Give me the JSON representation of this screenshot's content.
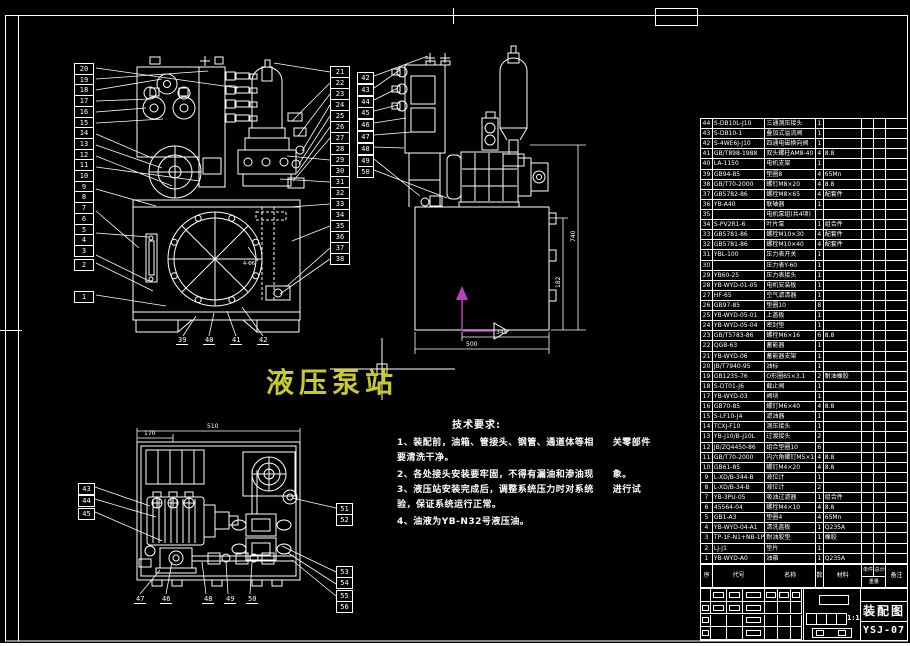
{
  "sheet": {
    "bg_color": "#000000",
    "line_color": "#ffffff",
    "title_color": "#c9c92a",
    "ucs_color": "#c03cc0"
  },
  "title": {
    "text": "液压泵站"
  },
  "tech": {
    "heading": "技术要求:",
    "lines": [
      "1、装配前，油箱、管接头、钢管、通道体等相　　关零部件",
      "要清洗干净。",
      "2、各处接头安装要牢固，不得有漏油和渗油现　　象。",
      "3、液压站安装完成后，调整系统压力时对系统　　进行试",
      "验，保证系统运行正常。",
      "4、油液为YB-N32号液压油。"
    ]
  },
  "dimensions": {
    "side_height": "740",
    "side_inner": "182",
    "side_width_inner": "345",
    "side_width": "500",
    "plan_width": "510",
    "plan_width_inner": "170",
    "front_hole_note": "4-Φ6"
  },
  "callouts": {
    "front_left": [
      "20",
      "19",
      "18",
      "17",
      "16",
      "15",
      "14",
      "13",
      "12",
      "11",
      "10",
      "9",
      "8",
      "7",
      "6",
      "5",
      "4",
      "3"
    ],
    "front_left_lower": [
      "2",
      "1"
    ],
    "front_right": [
      "21",
      "22",
      "23",
      "24",
      "25",
      "26",
      "27",
      "28",
      "29",
      "30",
      "31",
      "32",
      "33",
      "34",
      "35",
      "36",
      "37",
      "38"
    ],
    "front_bottom": [
      "39",
      "40",
      "41",
      "42"
    ],
    "side_left": [
      "42",
      "43",
      "44",
      "45",
      "46",
      "47",
      "48",
      "49",
      "50"
    ],
    "plan_left": [
      "43",
      "44",
      "45"
    ],
    "plan_bottom": [
      "47",
      "46",
      "48",
      "49",
      "50"
    ],
    "plan_right": [
      "51",
      "52",
      "53",
      "54",
      "55",
      "56"
    ]
  },
  "bom": {
    "headers": [
      "序号",
      "代号",
      "名称",
      "数量",
      "材料",
      "单件",
      "总计",
      "重量",
      "备注"
    ],
    "rows": [
      [
        "44",
        "S-DB10L-J10",
        "三通测压接头",
        "1",
        ""
      ],
      [
        "43",
        "S-DB10-1",
        "叠加式溢流阀",
        "1",
        ""
      ],
      [
        "42",
        "S-4WE6J-J10",
        "四通电磁换向阀",
        "1",
        ""
      ],
      [
        "41",
        "GB/T898-1988",
        "双头螺柱AM8-40",
        "4",
        "8.8"
      ],
      [
        "40",
        "LA-1150",
        "电机支架",
        "1",
        ""
      ],
      [
        "39",
        "GB94-85",
        "垫圈8",
        "4",
        "65Mn"
      ],
      [
        "38",
        "GB/T70-2000",
        "螺钉M8×20",
        "4",
        "8.8"
      ],
      [
        "37",
        "GB5782-86",
        "螺栓M8×65",
        "4",
        "配套件"
      ],
      [
        "36",
        "YB-A40",
        "联轴器",
        "1",
        ""
      ],
      [
        "35",
        "",
        "电机泵组(共4项)",
        "",
        ""
      ],
      [
        "34",
        "S-PV2R1-6",
        "叶片泵",
        "1",
        "组合件"
      ],
      [
        "33",
        "GB5781-86",
        "螺栓M10×30",
        "4",
        "配套件"
      ],
      [
        "32",
        "GB5781-86",
        "螺栓M10×40",
        "4",
        "配套件"
      ],
      [
        "31",
        "YBL-100",
        "压力表开关",
        "1",
        ""
      ],
      [
        "30",
        "",
        "压力表Y-60",
        "1",
        ""
      ],
      [
        "29",
        "YB60-25",
        "压力表接头",
        "1",
        ""
      ],
      [
        "28",
        "YB-WYD-01-05",
        "电机安装板",
        "1",
        ""
      ],
      [
        "27",
        "HF-65",
        "空气滤清器",
        "1",
        ""
      ],
      [
        "26",
        "GB97-85",
        "垫圈10",
        "8",
        ""
      ],
      [
        "25",
        "YB-WYD-05-01",
        "上盖板",
        "1",
        ""
      ],
      [
        "24",
        "YB-WYD-05-04",
        "密封垫",
        "1",
        ""
      ],
      [
        "23",
        "GB/T5783-86",
        "螺栓M6×16",
        "6",
        "8.8"
      ],
      [
        "22",
        "QGB-63",
        "蓄能器",
        "1",
        ""
      ],
      [
        "21",
        "YB-WYD-06",
        "蓄能器支架",
        "1",
        ""
      ],
      [
        "20",
        "JB/T7940-95",
        "油标",
        "1",
        ""
      ],
      [
        "19",
        "GB1235-76",
        "O形圈65×3.1",
        "2",
        "耐油橡胶"
      ],
      [
        "18",
        "S-DT01-J6",
        "截止阀",
        "1",
        ""
      ],
      [
        "17",
        "YB-WYD-03",
        "阀块",
        "1",
        ""
      ],
      [
        "16",
        "GB70-85",
        "螺钉M6×40",
        "4",
        "8.8"
      ],
      [
        "15",
        "S-LF10-J4",
        "滤油器",
        "1",
        ""
      ],
      [
        "14",
        "TCXJ-F10",
        "测压接头",
        "1",
        ""
      ],
      [
        "13",
        "YB-J10/B-J10L",
        "过渡接头",
        "2",
        ""
      ],
      [
        "12",
        "JB/ZQ4450-86",
        "组合垫圈10",
        "6",
        ""
      ],
      [
        "11",
        "GB/T70-2000",
        "内六角螺钉M5×16",
        "4",
        "8.8"
      ],
      [
        "10",
        "GB61-85",
        "螺钉M4×20",
        "4",
        "8.8"
      ],
      [
        "9",
        "L-XD/B-344-B",
        "液位计",
        "1",
        ""
      ],
      [
        "8",
        "L-XD/B-34-B",
        "液位计",
        "2",
        ""
      ],
      [
        "7",
        "YB-3PU-05",
        "吸油过滤器",
        "1",
        "组合件"
      ],
      [
        "6",
        "45564-04",
        "螺栓M4×10",
        "4",
        "8.8"
      ],
      [
        "5",
        "GB1-A3",
        "垫圈4",
        "4",
        "65Mn"
      ],
      [
        "4",
        "YB-WYD-04-A1",
        "清洗盖板",
        "1",
        "Q235A"
      ],
      [
        "3",
        "TP-1F-N1+NB-1P",
        "耐油胶垫",
        "1",
        "橡胶"
      ],
      [
        "2",
        "LJ-J1",
        "垫片",
        "1",
        ""
      ],
      [
        "1",
        "YB-WYD-A0",
        "油箱",
        "1",
        "Q235A"
      ]
    ]
  },
  "title_block": {
    "drawing_type": "装配图",
    "drawing_no": "YSJ-07",
    "scale": "1:1"
  }
}
